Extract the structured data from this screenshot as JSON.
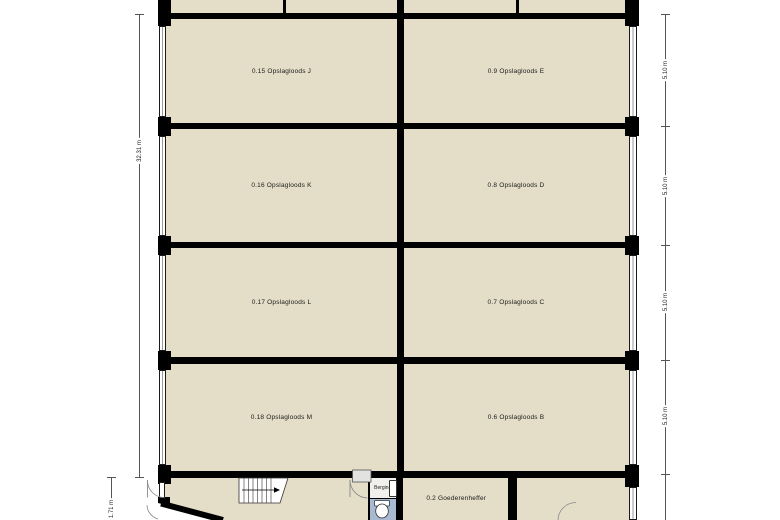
{
  "plan": {
    "rooms": [
      {
        "id": "storage-j",
        "label": "0.15 Opslagloods J"
      },
      {
        "id": "storage-e",
        "label": "0.9 Opslagloods E"
      },
      {
        "id": "storage-k",
        "label": "0.16 Opslagloods K"
      },
      {
        "id": "storage-d",
        "label": "0.8 Opslagloods D"
      },
      {
        "id": "storage-l",
        "label": "0.17 Opslagloods L"
      },
      {
        "id": "storage-c",
        "label": "0.7 Opslagloods C"
      },
      {
        "id": "storage-m",
        "label": "0.18 Opslagloods M"
      },
      {
        "id": "storage-b",
        "label": "0.6 Opslagloods B"
      },
      {
        "id": "berging",
        "label": "Berging"
      },
      {
        "id": "goederenheffer",
        "label": "0.2 Goederenheffer"
      }
    ],
    "dimensions": {
      "left_total": "32.31 m",
      "left_bottom": "1.71 m",
      "right_row_1": "5.10 m",
      "right_row_2": "5.10 m",
      "right_row_3": "5.10 m",
      "right_row_4": "5.10 m"
    },
    "colors": {
      "floor": "#e4ddc7",
      "wall": "#000000",
      "wet_room_floor": "#a8bad2",
      "berging_floor": "#f1f0ed",
      "dimension_line": "#555555"
    }
  }
}
